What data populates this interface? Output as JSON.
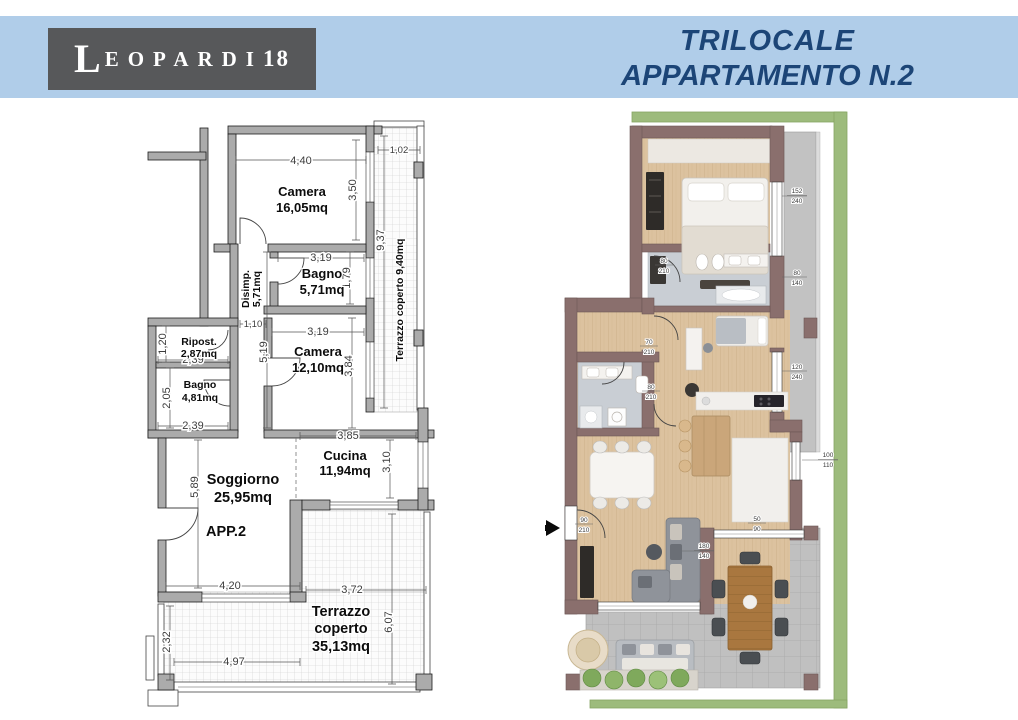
{
  "header": {
    "logo_l": "L",
    "logo_rest": "EOPARDI",
    "logo_num": "18",
    "title_line1": "TRILOCALE",
    "title_line2": "APPARTAMENTO N.2"
  },
  "plan2d": {
    "apartment_label": "APP.2",
    "rooms": {
      "camera1": {
        "name": "Camera",
        "area": "16,05mq"
      },
      "bagno1": {
        "name": "Bagno",
        "area": "5,71mq"
      },
      "disimp": {
        "name": "Disimp.",
        "area": "5,71mq"
      },
      "ripost": {
        "name": "Ripost.",
        "area": "2,87mq"
      },
      "bagno2": {
        "name": "Bagno",
        "area": "4,81mq"
      },
      "camera2": {
        "name": "Camera",
        "area": "12,10mq"
      },
      "soggiorno": {
        "name": "Soggiorno",
        "area": "25,95mq"
      },
      "cucina": {
        "name": "Cucina",
        "area": "11,94mq"
      },
      "terrazzo_lato": {
        "label": "Terrazzo coperto  9,40mq"
      },
      "terrazzo": {
        "line1": "Terrazzo",
        "line2": "coperto",
        "area": "35,13mq"
      }
    },
    "dims": {
      "top_camera": "4,40",
      "top_terrazzo": "1,02",
      "camera1_h": "3,50",
      "terrazzo_lato_h": "9,37",
      "bagno1_w": "3,19",
      "bagno1_h": "1,79",
      "disimp_w": "1,10",
      "disimp_h": "5,19",
      "camera2_w": "3,19",
      "camera2_h": "3,84",
      "ripost_h": "1,20",
      "ripost_w": "2,39",
      "bagno2_h": "2,05",
      "bagno2_w": "2,39",
      "cucina_w": "3,85",
      "cucina_h": "3,10",
      "soggiorno_h": "5,89",
      "soggiorno_w": "4,20",
      "terrazzo_top_w": "3,72",
      "terrazzo_h": "6,07",
      "terrazzo_left_h": "2,32",
      "terrazzo_w": "4,97"
    }
  },
  "plan3d": {
    "windows": [
      {
        "w": "152",
        "h": "240"
      },
      {
        "w": "80",
        "h": "140"
      },
      {
        "w": "120",
        "h": "240"
      },
      {
        "w": "100",
        "h": "110"
      },
      {
        "w": "50",
        "h": "90"
      },
      {
        "w": "180",
        "h": "140"
      }
    ],
    "doors": [
      {
        "w": "90",
        "h": "210"
      },
      {
        "w": "80",
        "h": "210"
      },
      {
        "w": "70",
        "h": "210"
      },
      {
        "w": "80",
        "h": "210"
      }
    ]
  },
  "colors": {
    "banner": "#b0cde9",
    "logo_bg": "#57585a",
    "title": "#1c4577",
    "wall_2d": "#ababab",
    "wall_3d": "#8a6f6d",
    "wood": "#dcc29f",
    "tile": "#c0c0c0",
    "hedge": "#9dbb7c"
  }
}
